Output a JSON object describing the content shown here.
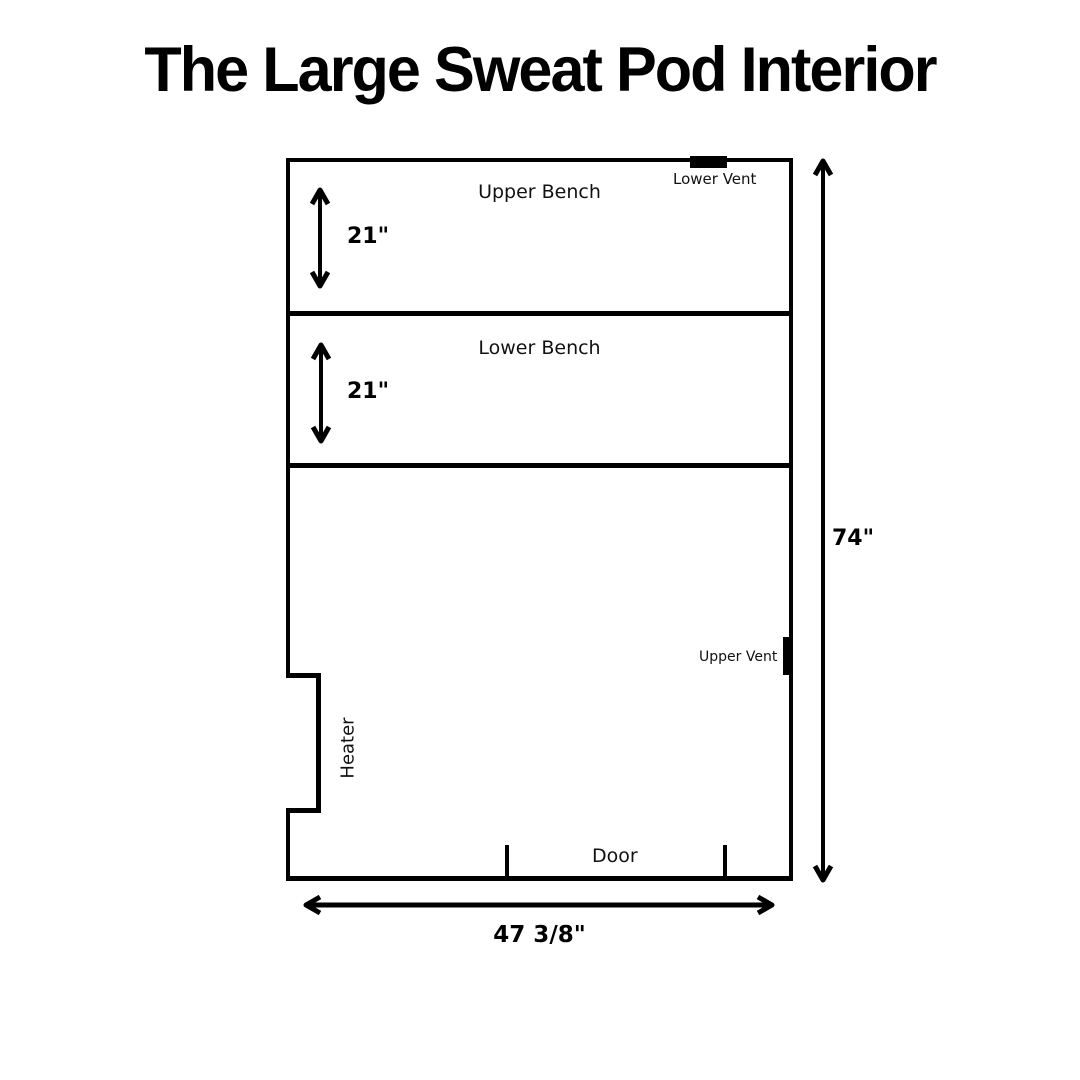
{
  "title": "The Large Sweat Pod Interior",
  "colors": {
    "line": "#000000",
    "background": "#ffffff",
    "text": "#000000"
  },
  "diagram": {
    "type": "interior-floor-plan",
    "regions": {
      "upper_bench": {
        "label": "Upper Bench",
        "depth": "21\""
      },
      "lower_bench": {
        "label": "Lower Bench",
        "depth": "21\""
      }
    },
    "features": {
      "heater": {
        "label": "Heater",
        "wall": "left"
      },
      "door": {
        "label": "Door",
        "wall": "bottom"
      },
      "lower_vent": {
        "label": "Lower Vent",
        "wall": "top"
      },
      "upper_vent": {
        "label": "Upper Vent",
        "wall": "right"
      }
    },
    "dimensions": {
      "height": "74\"",
      "width": "47 3/8\""
    }
  }
}
